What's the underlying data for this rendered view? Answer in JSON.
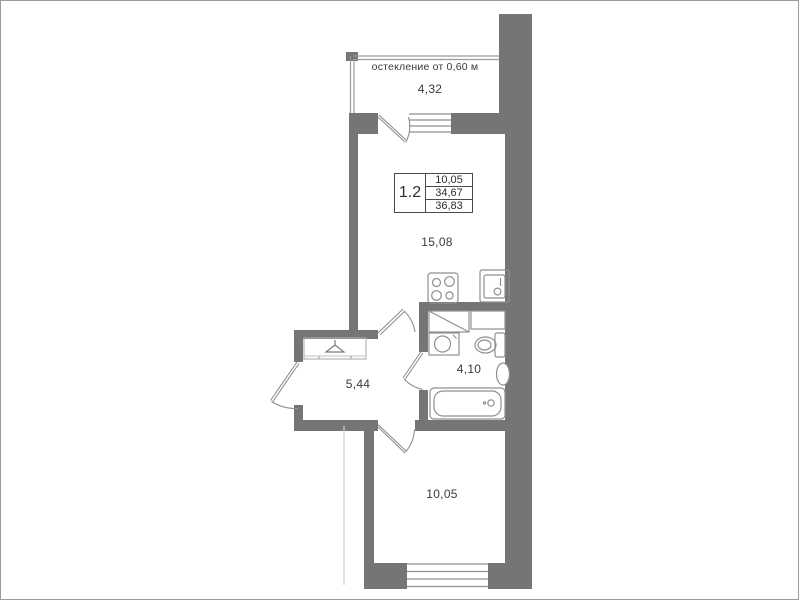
{
  "colors": {
    "wall": "#757575",
    "line": "#8f8f8f",
    "text": "#3a3a3a",
    "background": "#ffffff"
  },
  "balcony": {
    "glazing_note": "остекление от 0,60 м",
    "area": "4,32"
  },
  "rooms": {
    "living": {
      "area": "15,08"
    },
    "hallway": {
      "area": "5,44"
    },
    "bathroom": {
      "area": "4,10"
    },
    "bedroom": {
      "area": "10,05"
    }
  },
  "info_box": {
    "unit_type": "1.2",
    "row1": "10,05",
    "row2": "34,67",
    "row3": "36,83"
  },
  "icons": {
    "stove": "4-burner cooktop",
    "kitchen_sink": "kitchen sink unit",
    "cabinet": "cabinet with diagonal",
    "washbasin": "round washbasin",
    "toilet": "toilet with tank",
    "towel_rail": "oval towel radiator",
    "bathtub": "bathtub with drain",
    "wardrobe": "wardrobe with hanger",
    "door": "door leaf with swing arc",
    "window": "triple-line glazing"
  }
}
